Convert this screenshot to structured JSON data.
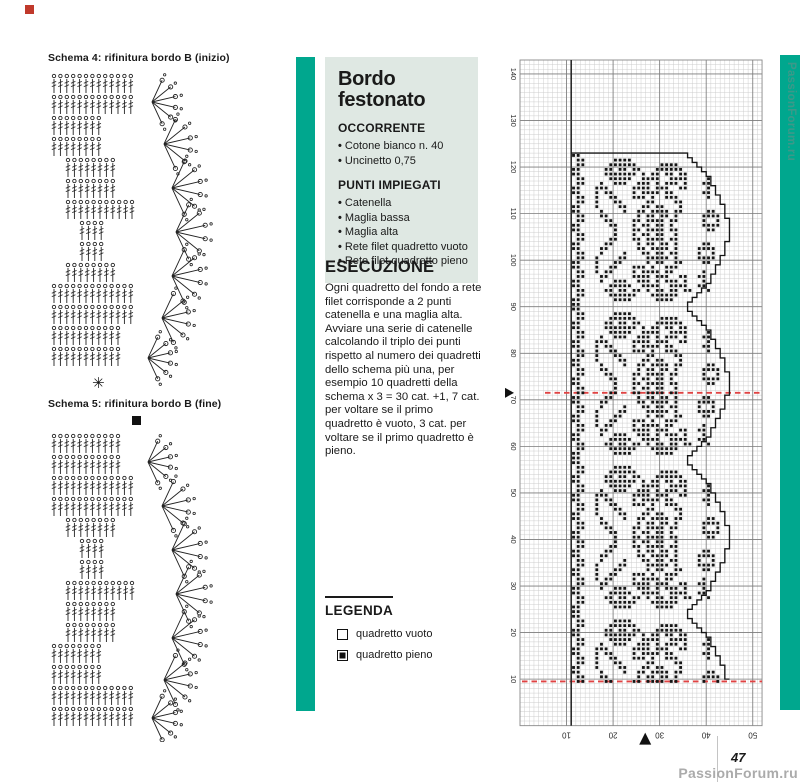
{
  "page": {
    "number": "47",
    "watermark": "PassionForum.ru"
  },
  "colors": {
    "teal": "#00a78e",
    "box_bg": "#dfe8e3",
    "dashed_red": "#e04343",
    "ink": "#1a1a1a",
    "corner_red": "#c0392b"
  },
  "left": {
    "schema4_title": "Schema 4: rifinitura bordo B (inizio)",
    "schema5_title": "Schema 5: rifinitura bordo B (fine)",
    "schema4_marker": "✳",
    "schema5_marker": "■"
  },
  "infobox": {
    "title_line1": "Bordo",
    "title_line2": "festonato",
    "sections": [
      {
        "heading": "OCCORRENTE",
        "items": [
          "Cotone bianco n. 40",
          "Uncinetto 0,75"
        ]
      },
      {
        "heading": "PUNTI IMPIEGATI",
        "items": [
          "Catenella",
          "Maglia bassa",
          "Maglia alta",
          "Rete filet quadretto vuoto",
          "Rete filet quadretto pieno"
        ]
      }
    ]
  },
  "esecuzione": {
    "heading": "ESECUZIONE",
    "body": "Ogni quadretto del fondo a rete filet corrisponde a 2 punti catenella e una maglia alta. Avviare una serie di catenelle calcolando il triplo dei punti rispetto al numero dei quadretti dello schema più una, per esempio 10 quadretti della schema x 3 = 30 cat. +1, 7 cat. per voltare se il primo quadretto è vuoto, 3 cat. per voltare se il primo quadretto è pieno."
  },
  "legend": {
    "heading": "LEGENDA",
    "items": [
      {
        "symbol": "empty-square",
        "label": "quadretto vuoto"
      },
      {
        "symbol": "filled-square",
        "label": "quadretto pieno"
      }
    ]
  },
  "chart_data": {
    "type": "heatmap",
    "title": "Filet crochet chart — scalloped floral border (Bordo festonato)",
    "grid": {
      "cols": 52,
      "rows": 143,
      "major_every": 10
    },
    "row_tick_labels": [
      "10",
      "20",
      "30",
      "40",
      "50",
      "60",
      "70",
      "80",
      "90",
      "100",
      "110",
      "120",
      "130",
      "140"
    ],
    "col_tick_labels": [
      "10",
      "20",
      "30",
      "40",
      "50"
    ],
    "pattern_start_col": 11,
    "pattern_top_row": 20,
    "pattern_bottom_row": 133,
    "motif_repeats": 4,
    "motif_rows": [
      "##................................",
      ".##......####.....................",
      ".##.....######.....####...........",
      "##.....##.##.##...######..........",
      "##.....#######.#.##.##.##.........",
      ".##.....#####..####..####....#....",
      ".##...#..###..###.#.###.#...##....",
      "##...###.....####.###..##....#....",
      "##...#.##....#.####.##......##....",
      ".##..#..##...###.#..###......#....",
      ".##..#...##.....##....##..........",
      "##...#....##...##.##...#..........",
      "##....#....#..##.####.##.....##...",
      ".##...##......#.##.##.#.....####..",
      ".##....##....##.####.##.....#..#..",
      "##......##...#.##.##.#......####..",
      "##.......#...##.####.##......##...",
      ".##......#...#.##.##..#...........",
      ".##.....##...##.####.##...........",
      "##.....##.....#.##.##.#.....##....",
      "##....##......##.####.#....####...",
      ".##...#....#...##.##.##....#..#...",
      ".##..#....##....#####.#....####...",
      "##...#...##.....#.##..##....##....",
      "##...#..##...###.#..###...........",
      ".##..#.##....#.####.##......#.....",
      ".##...##.....####.###..##..##.....",
      "##....#..###..###.#.###.#...#.....",
      "##......#####..####..####..##.....",
      ".##....##.##.##.#.##.##.##...#....",
      ".##.....######...######...........",
      "##.......####.....####............",
      "##................................"
    ],
    "motif_right_edge": [
      36,
      37,
      38,
      39,
      40,
      41,
      41,
      42,
      42,
      43,
      43,
      44,
      44,
      44,
      45,
      45,
      45,
      45,
      45,
      44,
      44,
      44,
      43,
      43,
      42,
      42,
      41,
      41,
      40,
      39,
      38,
      37,
      36
    ],
    "markers": {
      "dashed_row_upper": 71.5,
      "dashed_row_lower": 9.5,
      "left_triangle_row": 71.5,
      "bottom_triangle_col": 26.9
    }
  }
}
